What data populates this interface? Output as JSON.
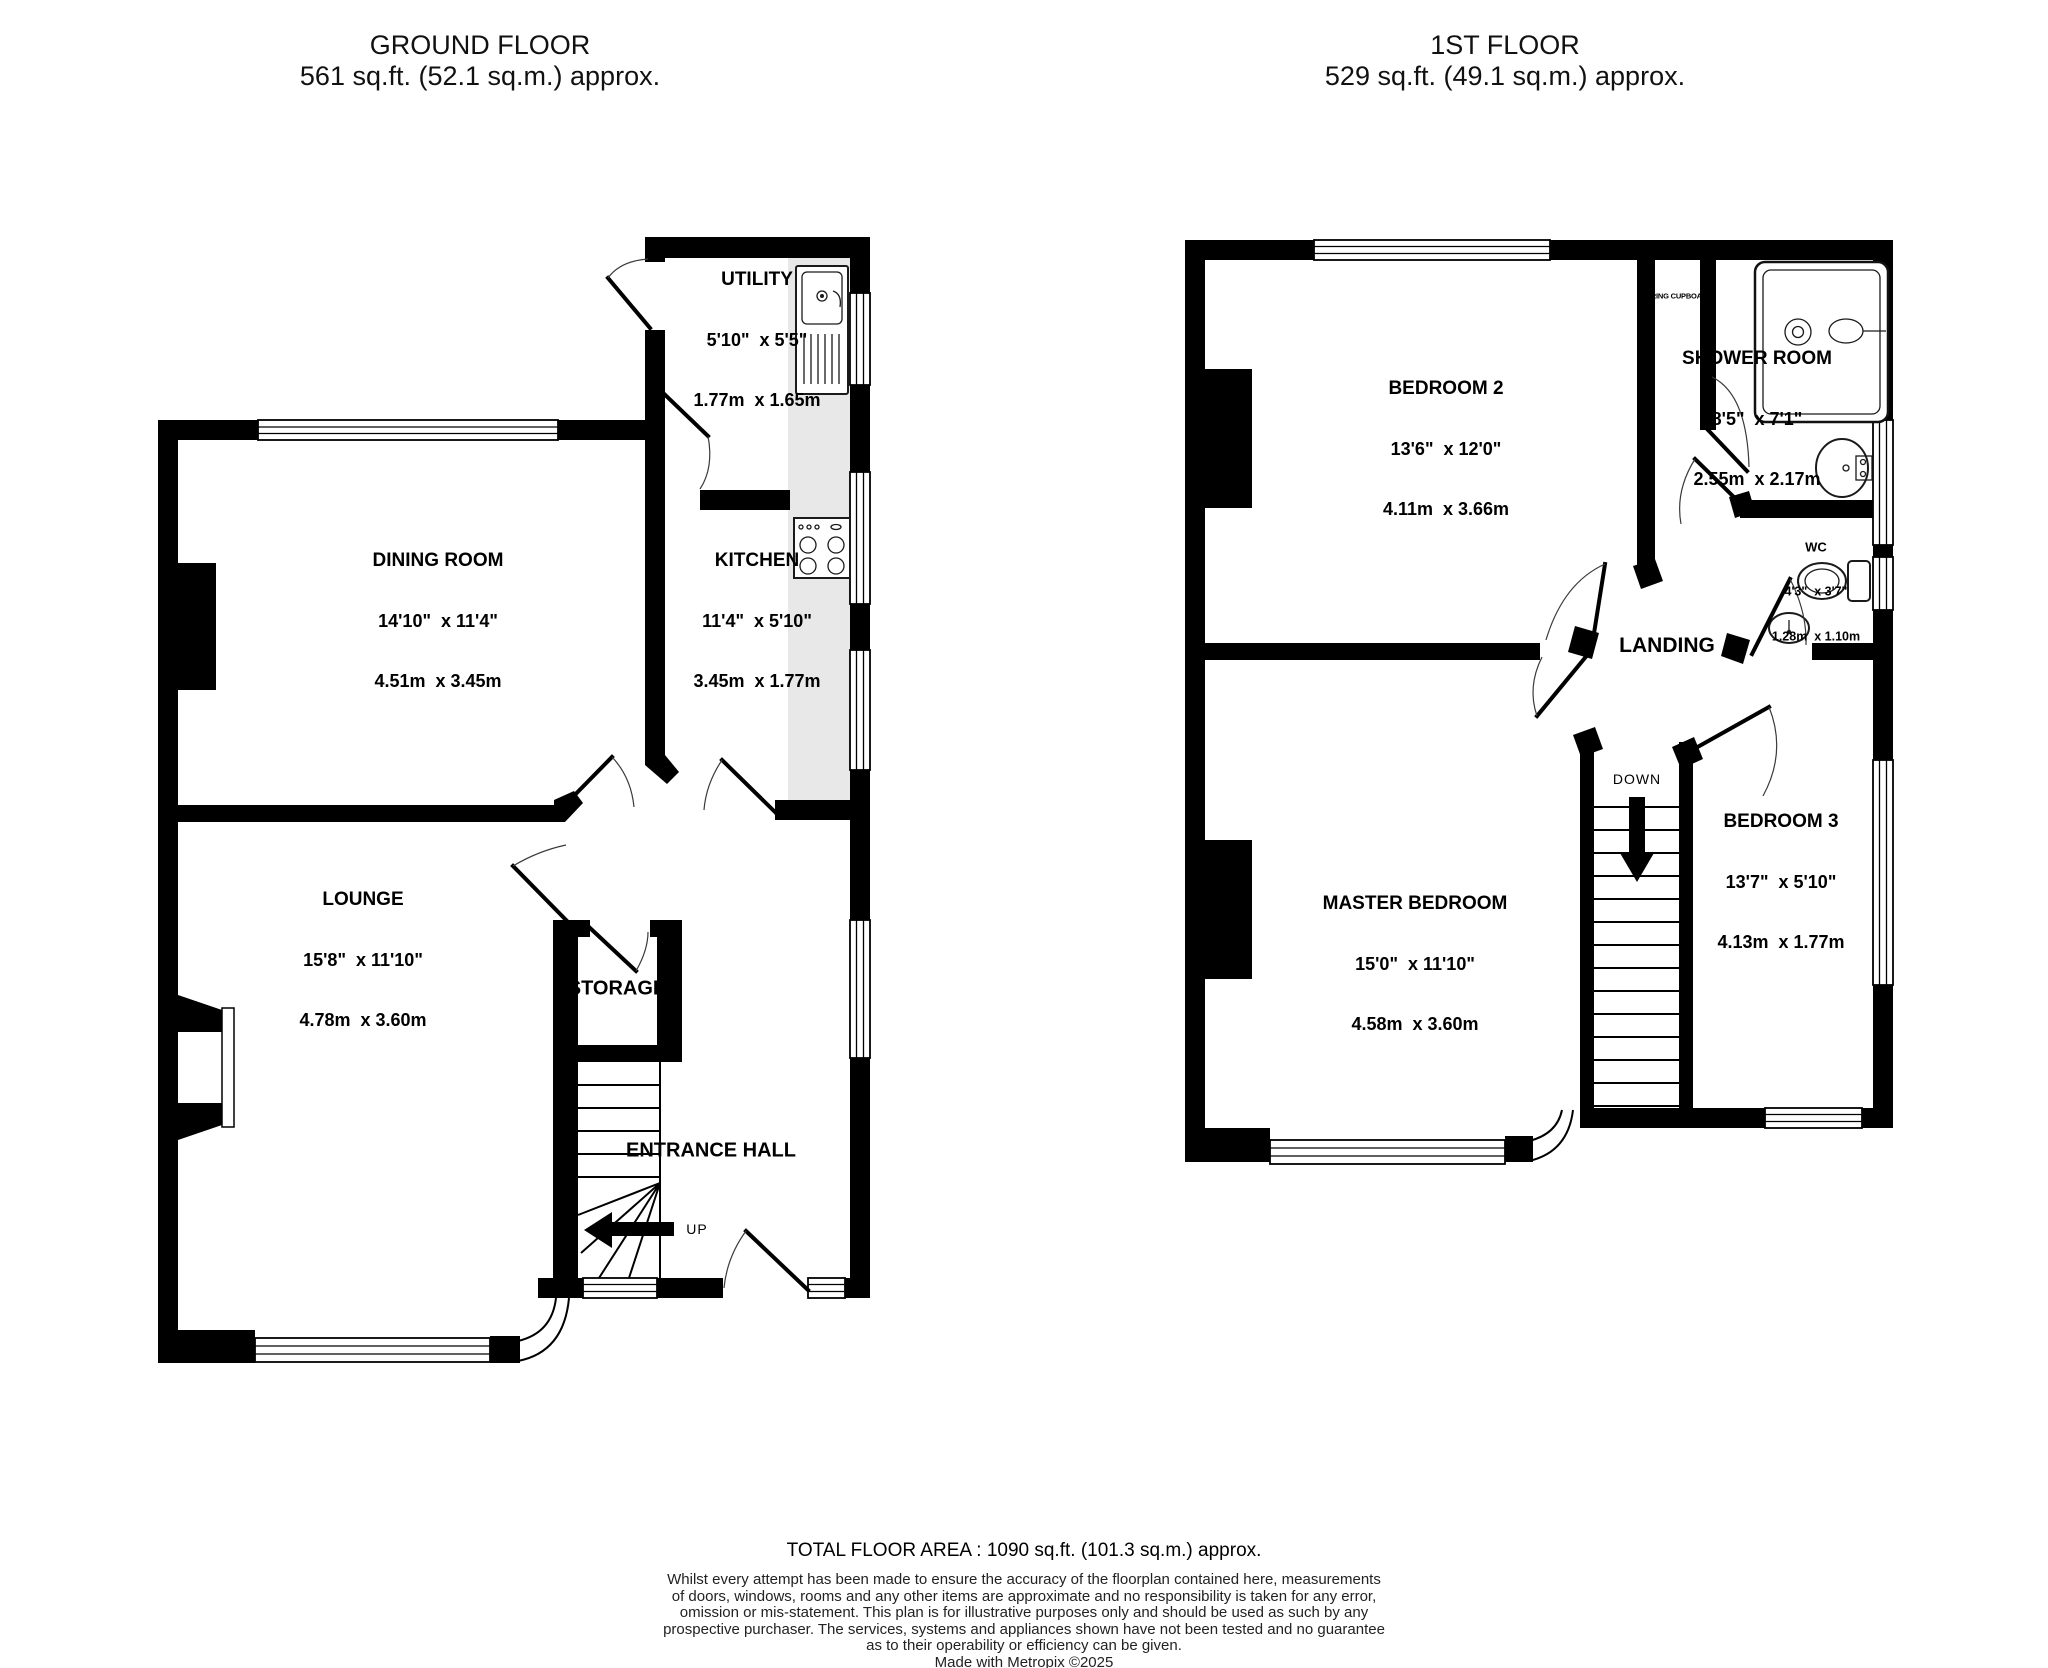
{
  "page": {
    "background": "#ffffff",
    "wall_color": "#000000",
    "counter_color": "#e8e8e8"
  },
  "floors": [
    {
      "title": "GROUND FLOOR",
      "area": "561 sq.ft. (52.1 sq.m.) approx.",
      "rooms": [
        {
          "name": "UTILITY",
          "imperial": "5'10\"  x 5'5\"",
          "metric": "1.77m  x 1.65m"
        },
        {
          "name": "DINING ROOM",
          "imperial": "14'10\"  x 11'4\"",
          "metric": "4.51m  x 3.45m"
        },
        {
          "name": "KITCHEN",
          "imperial": "11'4\"  x 5'10\"",
          "metric": "3.45m  x 1.77m"
        },
        {
          "name": "LOUNGE",
          "imperial": "15'8\"  x 11'10\"",
          "metric": "4.78m  x 3.60m"
        }
      ],
      "labels": {
        "storage": "STORAGE",
        "entrance_hall": "ENTRANCE HALL",
        "up": "UP"
      }
    },
    {
      "title": "1ST FLOOR",
      "area": "529 sq.ft. (49.1 sq.m.) approx.",
      "rooms": [
        {
          "name": "BEDROOM 2",
          "imperial": "13'6\"  x 12'0\"",
          "metric": "4.11m  x 3.66m"
        },
        {
          "name": "SHOWER ROOM",
          "imperial": "8'5\"  x 7'1\"",
          "metric": "2.55m  x 2.17m"
        },
        {
          "name": "WC",
          "imperial": "4'3\"  x 3'7\"",
          "metric": "1.28m  x 1.10m"
        },
        {
          "name": "MASTER BEDROOM",
          "imperial": "15'0\"  x 11'10\"",
          "metric": "4.58m  x 3.60m"
        },
        {
          "name": "BEDROOM 3",
          "imperial": "13'7\"  x 5'10\"",
          "metric": "4.13m  x 1.77m"
        }
      ],
      "labels": {
        "landing": "LANDING",
        "down": "DOWN",
        "airing_cupboard": "AIRING CUPBOARD"
      }
    }
  ],
  "footer": {
    "total": "TOTAL FLOOR AREA : 1090 sq.ft. (101.3 sq.m.) approx.",
    "disclaimer_lines": [
      "Whilst every attempt has been made to ensure the accuracy of the floorplan contained here, measurements",
      "of doors, windows, rooms and any other items are approximate and no responsibility is taken for any error,",
      "omission or mis-statement. This plan is for illustrative purposes only and should be used as such by any",
      "prospective purchaser. The services, systems and appliances shown have not been tested and no guarantee",
      "as to their operability or efficiency can be given.",
      "Made with Metropix ©2025"
    ]
  }
}
